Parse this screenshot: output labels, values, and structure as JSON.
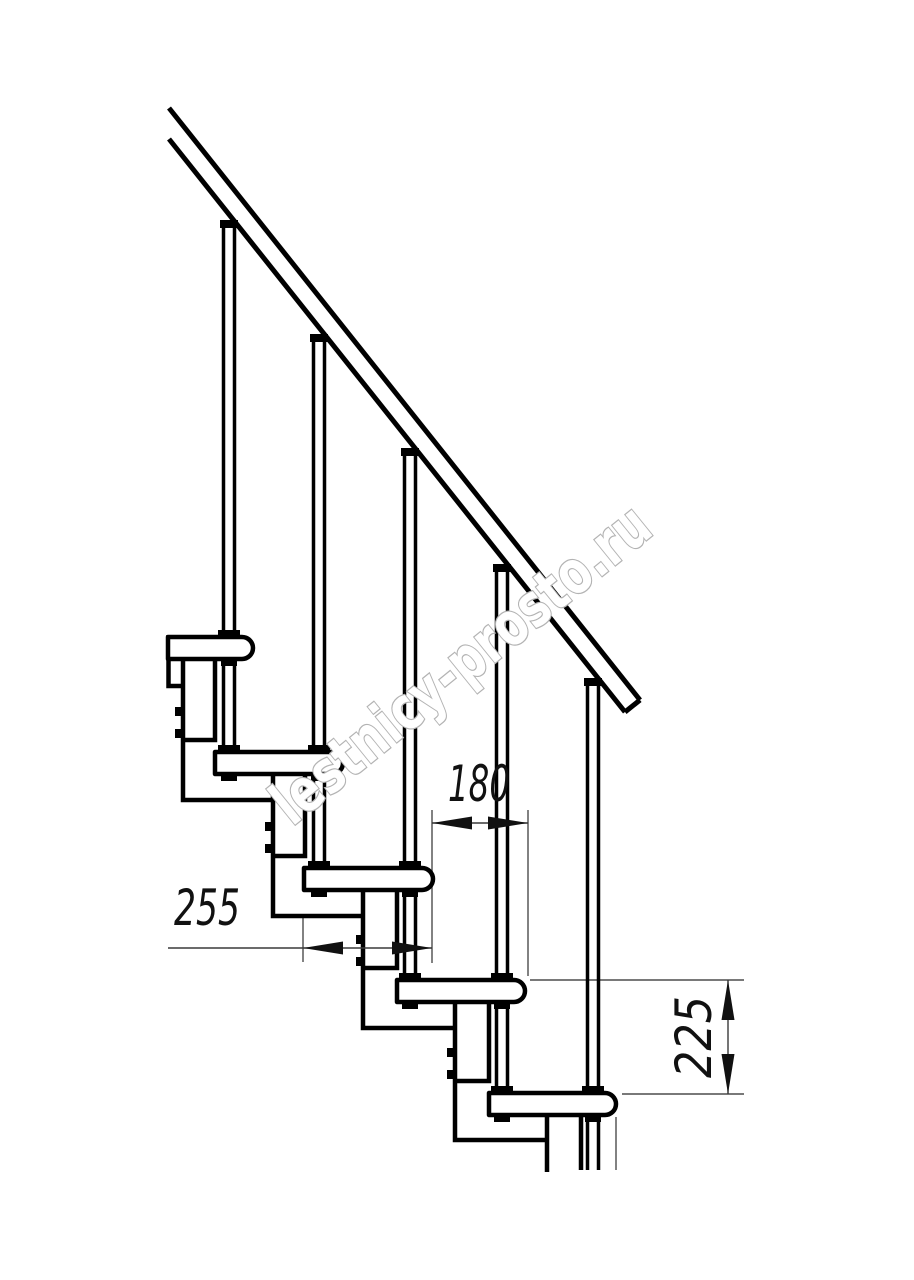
{
  "drawing": {
    "title": "modular-staircase-side-view",
    "dimensions": {
      "step_offset": "180",
      "tread_depth": "255",
      "step_rise": "225"
    },
    "watermark": "lestnicy-prosto.ru",
    "colors": {
      "line": "#000000",
      "dimension_line": "#4d4d4d",
      "dimension_text": "#111111",
      "watermark_outline": "#b3b3b3",
      "background": "#ffffff"
    }
  }
}
